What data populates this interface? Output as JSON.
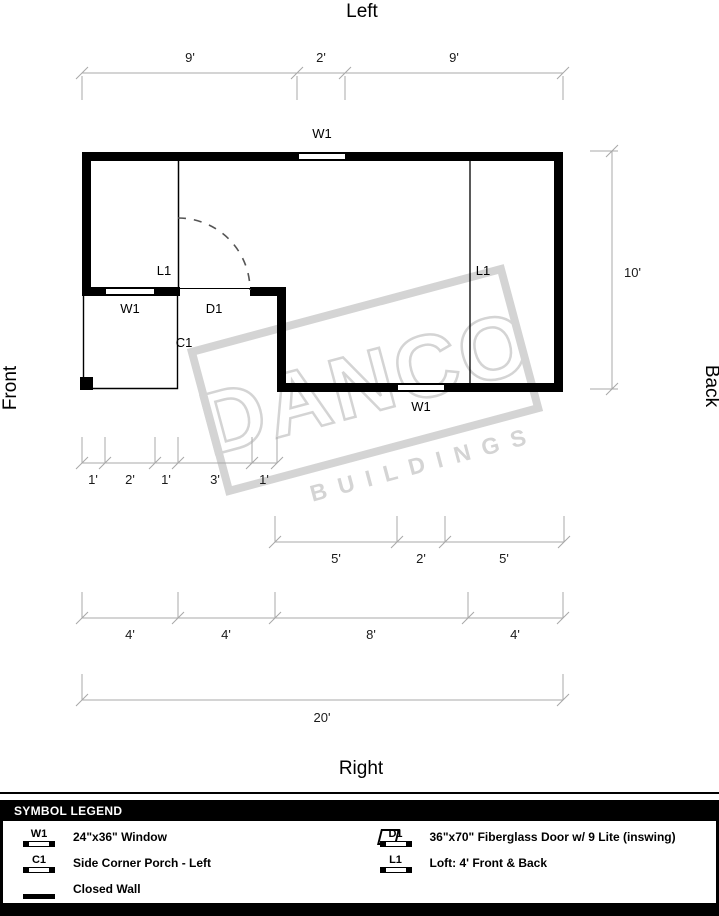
{
  "orientation": {
    "top": "Left",
    "bottom": "Right",
    "left": "Front",
    "right": "Back"
  },
  "watermark": {
    "line1": "DANCO",
    "line2": "BUILDINGS",
    "color": "#d4d4d4"
  },
  "plan": {
    "window": "W1",
    "door": "D1",
    "porch": "C1",
    "loft": "L1"
  },
  "dims": {
    "top": [
      "9'",
      "2'",
      "9'"
    ],
    "side": "10'",
    "porch_row": [
      "1'",
      "2'",
      "1'",
      "3'",
      "1'"
    ],
    "back_row": [
      "5'",
      "2'",
      "5'"
    ],
    "loft_row": [
      "4'",
      "4'",
      "8'",
      "4'"
    ],
    "total": "20'"
  },
  "colors": {
    "wall": "#000000",
    "dim_line": "#a8a8a8",
    "dim_text": "#1a1a1a",
    "door_swing": "#555555"
  },
  "legend": {
    "header": "SYMBOL LEGEND",
    "col1": [
      {
        "code": "W1",
        "desc": "24\"x36\" Window"
      },
      {
        "code": "C1",
        "desc": "Side Corner Porch - Left"
      },
      {
        "code": "",
        "desc": "Closed Wall"
      }
    ],
    "col2": [
      {
        "code": "D1",
        "desc": "36\"x70\" Fiberglass Door w/ 9 Lite (inswing)"
      },
      {
        "code": "L1",
        "desc": "Loft: 4' Front & Back"
      }
    ]
  }
}
